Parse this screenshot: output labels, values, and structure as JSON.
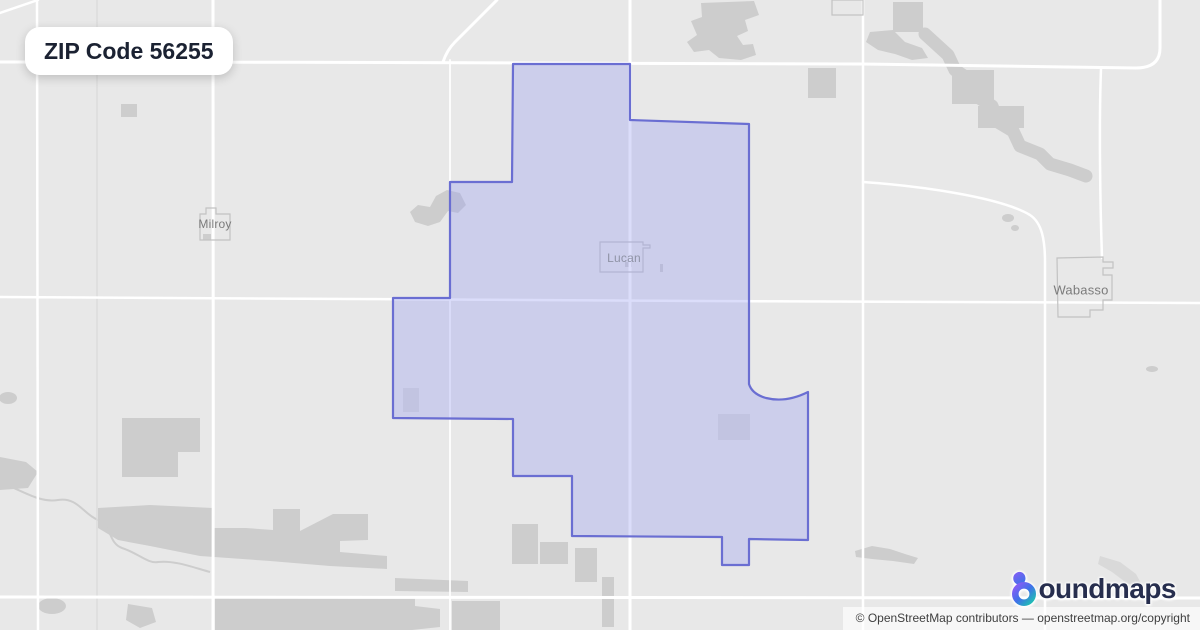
{
  "header": {
    "title": "ZIP Code 56255",
    "zip_code": "56255"
  },
  "map": {
    "labels": {
      "milroy": "Milroy",
      "lucan": "Lucan",
      "wabasso": "Wabasso"
    }
  },
  "branding": {
    "logo_full_name": "boundmaps",
    "logo_text": "oundmaps",
    "logo_icon": "boundmaps-b-droplet-ring"
  },
  "attribution": {
    "prefix": "© OpenStreetMap contributors — ",
    "link": "openstreetmap.org/copyright"
  },
  "colors": {
    "map_bg": "#e8e8e8",
    "landuse_patch": "#cdcdcd",
    "landuse_patch_light": "#d9d9d9",
    "road_major": "#ffffff",
    "road_minor": "#dcdcdc",
    "town_outline": "#c2c2c2",
    "zip_fill": "rgba(151,158,240,0.35)",
    "zip_stroke": "#6a6ed2",
    "map_label": "#7b7b7b",
    "badge_bg": "#ffffff",
    "badge_text": "#1b2232",
    "attribution_bg": "rgba(255,255,255,0.65)",
    "attribution_text": "#3f3f3f",
    "logo_text": "#272e4e",
    "logo_gradient_start": "#8a5cf6",
    "logo_gradient_mid": "#3f72e8",
    "logo_gradient_end": "#1fc0b2"
  }
}
